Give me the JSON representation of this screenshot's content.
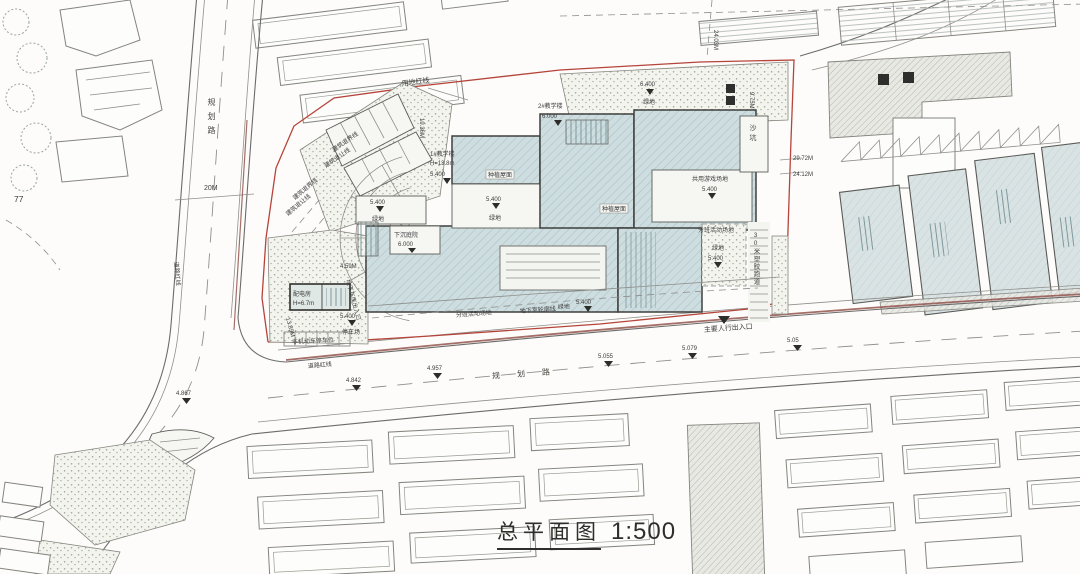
{
  "drawing": {
    "title": "总平面图",
    "scale": "1:500",
    "parcel_label": "77"
  },
  "roads": {
    "width": "20M",
    "name_left": "规划路",
    "name_bottom": "规划路"
  },
  "boundary": {
    "land_red_line": "用地红线",
    "road_red_line": "道路红线",
    "setback_1": "建筑退界线",
    "setback_2": "建筑退让线",
    "basement_outline": "地下室轮廓线"
  },
  "buildings": {
    "b1_name": "1#教学楼",
    "b1_height": "H=13.8m",
    "b1_elev": "5.400",
    "b2_name": "2#教学楼",
    "b2_elev": "6.000",
    "gate_name": "配电房",
    "gate_height": "H=6.7m",
    "planted_roof": "种植屋面"
  },
  "site": {
    "green": "绿地",
    "green_elev": "5.400",
    "green_elev_top": "6.400",
    "sunken": "下沉庭院",
    "sunken_elev": "6.000",
    "sand_pit": "沙坑",
    "shared_play": "共用游戏场地",
    "shared_play_elev": "5.400",
    "class_activity": "分班活动场地",
    "class_activity_elev": "5.400",
    "track": "30米塑胶跑道",
    "parking": "停车场",
    "parking_elev": "5.400",
    "bike_parking": "非机动车停车位"
  },
  "entrances": {
    "main_pedestrian": "主要人行出入口",
    "garage": "地下车库出入口"
  },
  "elevations": {
    "e1": "4.867",
    "e2": "4.842",
    "e3": "4.957",
    "e4": "5.055",
    "e5": "5.079",
    "e6": "5.05"
  },
  "dimensions": {
    "d1": "24.03M",
    "d2": "29.72M",
    "d3": "24.12M",
    "d4": "19.36M",
    "d5": "9.75M",
    "d6": "4.59M",
    "d7": "13.89M"
  },
  "colors": {
    "building_fill": "#cedde0",
    "context_fill": "#dae3e4",
    "red_line": "#b5443a",
    "line": "#6b6b6b",
    "text": "#3c3c3c"
  }
}
